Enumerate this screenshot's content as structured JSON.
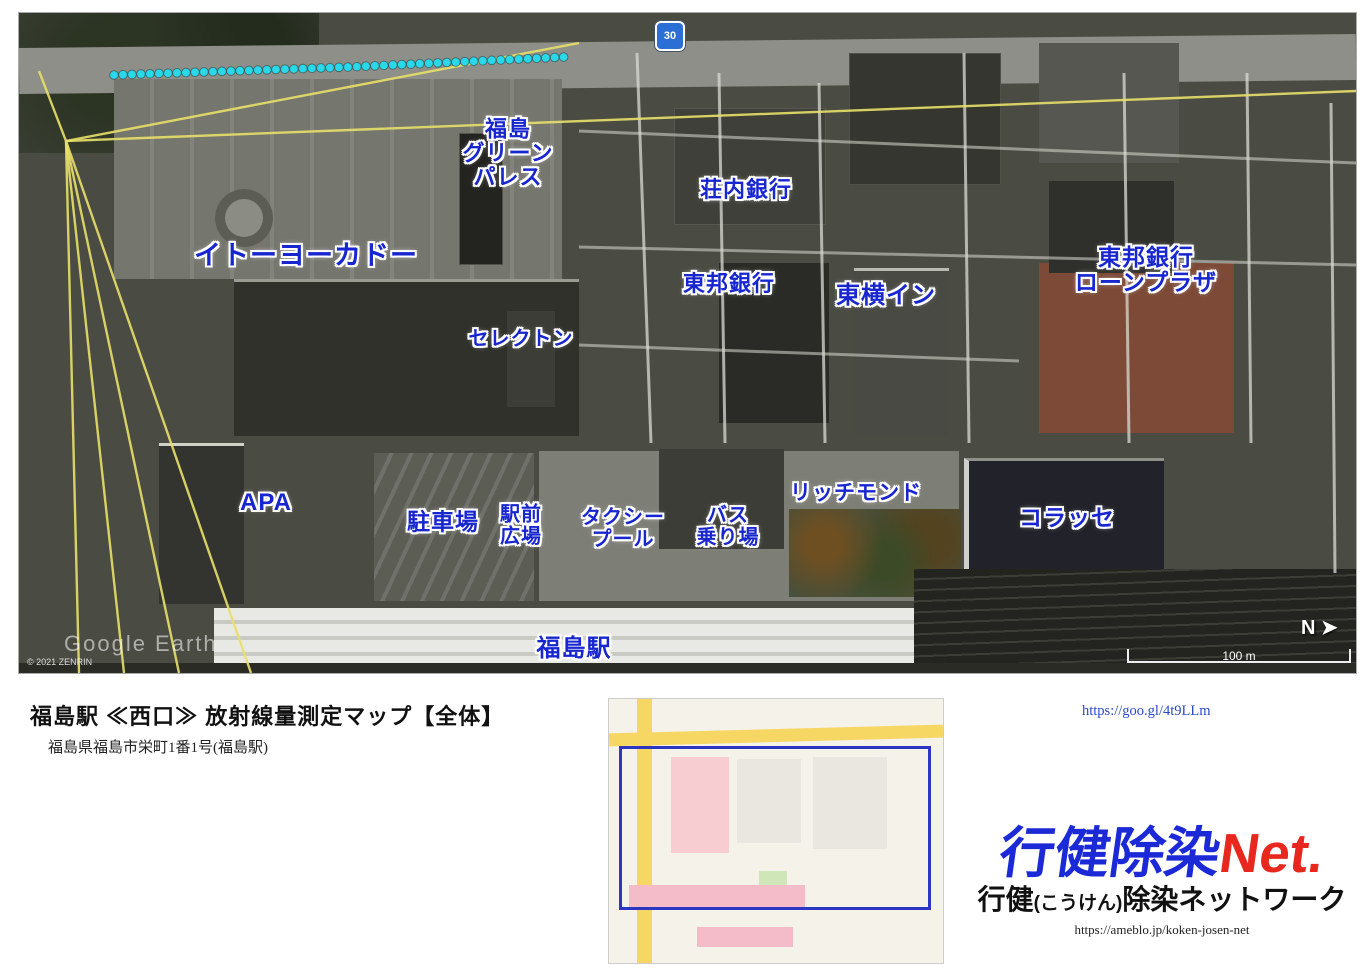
{
  "map": {
    "speed_sign": "30",
    "scale_label": "100 m",
    "north_label": "N",
    "watermark": "Google Earth",
    "copyright": "© 2021 ZENRIN",
    "labels": [
      {
        "t": "イトーヨーカドー",
        "x": 287,
        "y": 243,
        "s": 27
      },
      {
        "t": "福島\nグリーン\nパレス",
        "x": 489,
        "y": 140,
        "s": 22
      },
      {
        "t": "セレクトン",
        "x": 502,
        "y": 327,
        "s": 20
      },
      {
        "t": "荘内銀行",
        "x": 727,
        "y": 177,
        "s": 22
      },
      {
        "t": "東邦銀行",
        "x": 710,
        "y": 271,
        "s": 22
      },
      {
        "t": "東横イン",
        "x": 867,
        "y": 283,
        "s": 24
      },
      {
        "t": "東邦銀行\nローンプラザ",
        "x": 1127,
        "y": 257,
        "s": 23
      },
      {
        "t": "APA",
        "x": 247,
        "y": 490,
        "s": 24
      },
      {
        "t": "駐車場",
        "x": 424,
        "y": 509,
        "s": 23
      },
      {
        "t": "駅前\n広場",
        "x": 502,
        "y": 513,
        "s": 20
      },
      {
        "t": "タクシー\nプール",
        "x": 604,
        "y": 516,
        "s": 20
      },
      {
        "t": "バス\n乗り場",
        "x": 709,
        "y": 514,
        "s": 20
      },
      {
        "t": "リッチモンド",
        "x": 837,
        "y": 481,
        "s": 21
      },
      {
        "t": "コラッセ",
        "x": 1048,
        "y": 505,
        "s": 23
      },
      {
        "t": "福島駅",
        "x": 555,
        "y": 636,
        "s": 24
      }
    ],
    "value_colors": {
      "blue": "#1420dd",
      "cyan": "#2bd8ea",
      "green": "#23d523",
      "yellow": "#f2ee2a",
      "orange": "#f5a21f",
      "red": "#ee1414"
    },
    "runs": [
      {
        "pts": [
          [
            95,
            62
          ],
          [
            330,
            54
          ],
          [
            545,
            44
          ]
        ],
        "v": [
          0.1,
          0.12,
          0.11,
          0.11,
          0.11,
          0.12,
          0.11,
          0.12,
          0.1,
          0.1,
          0.13,
          0.11,
          0.12
        ],
        "side": "A",
        "step": 9
      },
      {
        "pts": [
          [
            663,
            42
          ],
          [
            950,
            76
          ],
          [
            1205,
            114
          ]
        ],
        "v": [
          0.1,
          0.1,
          0.09,
          0.08,
          0.08,
          0.07,
          0.09,
          0.1,
          0.1,
          0.11,
          0.1,
          0.12,
          0.12,
          0.1,
          0.09,
          0.1,
          0.16
        ],
        "side": "A",
        "step": 9
      },
      {
        "pts": [
          [
            1207,
            118
          ],
          [
            1213,
            240
          ],
          [
            1210,
            418
          ]
        ],
        "v": [
          0.11,
          0.2,
          0.09,
          0.09,
          0.06,
          0.04,
          0.08,
          0.09,
          0.12,
          0.1,
          0.13,
          0.11
        ],
        "side": "L",
        "step": 9
      },
      {
        "pts": [
          [
            1294,
            142
          ],
          [
            1300,
            300
          ],
          [
            1297,
            440
          ],
          [
            1295,
            552
          ]
        ],
        "v": [
          0.16,
          0.2,
          0.09,
          0.08,
          0.06,
          0.12,
          0.1,
          0.11,
          0.16,
          0.18,
          0.16
        ],
        "side": "L",
        "step": 10
      },
      {
        "pts": [
          [
            100,
            78
          ],
          [
            107,
            240
          ],
          [
            113,
            418
          ]
        ],
        "v": [
          0.12,
          0.1,
          0.11,
          0.13,
          0.12,
          0.11,
          0.13,
          0.12,
          0.14,
          0.12,
          0.17,
          0.14,
          0.12,
          0.11,
          0.16,
          0.1
        ],
        "side": "L",
        "step": 9
      },
      {
        "pts": [
          [
            338,
            70
          ],
          [
            344,
            240
          ],
          [
            350,
            420
          ]
        ],
        "v": [
          0.1,
          0.12,
          0.16,
          0.12,
          0.13,
          0.12,
          0.14,
          0.12,
          0.13,
          0.11,
          0.14,
          0.15
        ],
        "side": "L",
        "step": 9
      },
      {
        "pts": [
          [
            444,
            82
          ],
          [
            452,
            220
          ],
          [
            458,
            330
          ],
          [
            462,
            420
          ]
        ],
        "v": [
          0.16,
          0.2,
          0.2,
          0.18,
          0.17,
          0.15,
          0.2,
          0.22,
          0.2,
          0.22,
          0.19,
          0.21,
          0.23,
          0.24,
          0.23,
          0.21
        ],
        "side": "L",
        "step": 9.5
      },
      {
        "pts": [
          [
            540,
            50
          ],
          [
            558,
            140
          ],
          [
            574,
            240
          ],
          [
            590,
            330
          ],
          [
            602,
            420
          ]
        ],
        "v": [
          0.07,
          0.05,
          0.09,
          0.05,
          0.09,
          0.14,
          0.13,
          0.08,
          0.06,
          0.07,
          0.08,
          0.07,
          0.09,
          0.1,
          0.12,
          0.09,
          0.08
        ],
        "side": "L",
        "step": 9.5
      },
      {
        "pts": [
          [
            630,
            82
          ],
          [
            637,
            210
          ],
          [
            641,
            320
          ],
          [
            645,
            428
          ]
        ],
        "v": [
          0.09,
          0.08,
          0.07,
          0.07,
          0.06,
          0.05,
          0.04,
          0.07,
          0.05,
          0.07,
          0.12,
          0.1
        ],
        "side": "R",
        "step": 9.5
      },
      {
        "pts": [
          [
            770,
            98
          ],
          [
            777,
            230
          ],
          [
            781,
            330
          ],
          [
            785,
            424
          ]
        ],
        "v": [
          0.08,
          0.07,
          0.1,
          0.1,
          0.11,
          0.08,
          0.11,
          0.1,
          0.09,
          0.11,
          0.12,
          0.13,
          0.13,
          0.11
        ],
        "side": "L",
        "step": 9.5
      },
      {
        "pts": [
          [
            917,
            52
          ],
          [
            922,
            170
          ],
          [
            927,
            290
          ],
          [
            931,
            424
          ]
        ],
        "v": [
          0.09,
          0.07,
          0.11,
          0.12,
          0.13,
          0.11,
          0.16,
          0.08,
          0.12,
          0.16,
          0.13,
          0.14,
          0.15
        ],
        "side": "L",
        "step": 9.5
      },
      {
        "pts": [
          [
            822,
            226
          ],
          [
            933,
            237
          ]
        ],
        "v": [
          0.08,
          0.07,
          0.12,
          0.21,
          0.07
        ],
        "side": "U",
        "step": 9
      },
      {
        "pts": [
          [
            113,
            428
          ],
          [
            420,
            423
          ],
          [
            760,
            428
          ],
          [
            1040,
            425
          ],
          [
            1207,
            420
          ]
        ],
        "v": [
          0.1,
          0.14,
          0.15,
          0.14,
          0.17,
          0.15,
          0.09,
          0.13,
          0.11,
          0.1,
          0.11,
          0.06,
          0.07,
          0.1,
          0.11,
          0.11,
          0.09,
          0.08,
          0.06,
          0.07,
          0.09,
          0.11,
          0.14,
          0.13
        ],
        "side": "U",
        "step": 9
      },
      {
        "pts": [
          [
            130,
            453
          ],
          [
            420,
            450
          ],
          [
            760,
            453
          ],
          [
            1030,
            450
          ],
          [
            1148,
            452
          ]
        ],
        "v": [
          0.08,
          0.06,
          0.07,
          0.1,
          0.08,
          0.06,
          0.06,
          0.05,
          0.04,
          0.07,
          0.05,
          0.05,
          0.04,
          0.04,
          0.09,
          0.07,
          0.06,
          0.07,
          0.08,
          0.06,
          0.08,
          0.09,
          0.1,
          0.07
        ],
        "side": "D",
        "step": 9
      },
      {
        "pts": [
          [
            117,
            445
          ],
          [
            119,
            505
          ],
          [
            121,
            556
          ]
        ],
        "v": [
          0.05,
          0.05,
          0.06,
          0.05,
          0.06,
          0.07,
          0.1
        ],
        "side": "L",
        "step": 9.5
      },
      {
        "pts": [
          [
            128,
            572
          ],
          [
            350,
            578
          ],
          [
            600,
            576
          ],
          [
            752,
            572
          ]
        ],
        "v": [
          0.07,
          0.08,
          0.06,
          0.04,
          0.04,
          0.06,
          0.05,
          0.06,
          0.06,
          0.07,
          0.06,
          0.05,
          0.06,
          0.03,
          0.06,
          0.06,
          0.07,
          0.03,
          0.04,
          0.05,
          0.06,
          0.08
        ],
        "side": "D",
        "step": 9
      },
      {
        "pts": [
          [
            758,
            574
          ],
          [
            950,
            581
          ],
          [
            1193,
            580
          ]
        ],
        "v": [
          0.15,
          0.16,
          0.21,
          0.19,
          0.24,
          0.31,
          0.3,
          0.27,
          0.27,
          0.31,
          0.25,
          0.28,
          0.26,
          0.33,
          0.25,
          0.22,
          0.16
        ],
        "side": "D",
        "step": 10
      },
      {
        "pts": [
          [
            772,
            442
          ],
          [
            777,
            505
          ],
          [
            779,
            560
          ]
        ],
        "v": [
          0.2,
          0.19,
          0.22,
          0.2,
          0.23,
          0.36,
          0.18
        ],
        "side": "R",
        "step": 10
      },
      {
        "pts": [
          [
            642,
            445
          ],
          [
            646,
            510
          ],
          [
            648,
            566
          ]
        ],
        "v": [
          0.05,
          0.07,
          0.05,
          0.08,
          0.06,
          0.06,
          0.09
        ],
        "side": "L",
        "step": 10
      },
      {
        "pts": [
          [
            887,
            445
          ],
          [
            891,
            510
          ],
          [
            893,
            566
          ]
        ],
        "v": [
          0.05,
          0.03,
          0.06,
          0.02,
          0.08,
          0.06,
          0.04,
          0.05
        ],
        "side": "L",
        "step": 10
      },
      {
        "pts": [
          [
            1180,
            448
          ],
          [
            1184,
            520
          ],
          [
            1186,
            580
          ]
        ],
        "v": [
          0.07,
          0.18,
          0.13,
          0.16,
          0.18
        ],
        "side": "L",
        "step": 11
      },
      {
        "pts": [
          [
            357,
            443
          ],
          [
            361,
            510
          ],
          [
            363,
            572
          ]
        ],
        "v": [
          0.07,
          0.05,
          0.05,
          0.06,
          0.05,
          0.06,
          0.05,
          0.07
        ],
        "side": "L",
        "step": 10
      }
    ]
  },
  "info": {
    "title": "福島駅 ≪西口≫ 放射線量測定マップ【全体】",
    "address": "福島県福島市栄町1番1号(福島駅)",
    "details": [
      {
        "label": "◇測　定　日",
        "value": "2021(R03)年03月08日(月曜日)"
      },
      {
        "label": "◇測定単位",
        "value": "μSv/h(マイクロシーベルト毎時)"
      },
      {
        "label": "◇測定機器",
        "value": "ホットスポットファインダー"
      },
      {
        "label": "◇測定高さ",
        "value": "10cm"
      },
      {
        "label": "◇天　　候",
        "value": "はれ"
      },
      {
        "label": "◇地面状況",
        "value": "乾燥"
      },
      {
        "label": "◇制　　作",
        "maker": true
      }
    ],
    "maker_parts": [
      {
        "t": "行健",
        "cls": "mk-b"
      },
      {
        "t": "(こうけん)",
        "cls": "mk-k"
      },
      {
        "t": "除染",
        "cls": "mk-b"
      },
      {
        "t": "ネットワーク",
        "cls": "mk-r"
      }
    ]
  },
  "legend": {
    "items": [
      {
        "color": "#0b10e3",
        "label": "0. 00μ Sv/h 以上"
      },
      {
        "color": "#17e8f4",
        "label": "0. 10μ Sv/h 以上"
      },
      {
        "color": "#19d419",
        "label": "0. 20μ Sv/h 以上"
      },
      {
        "color": "#f2f21b",
        "label": "0. 24μ Sv/h 以上"
      },
      {
        "color": "#f5a11c",
        "label": "0. 30μ Sv/h 以上"
      },
      {
        "color": "#ef1212",
        "label": "0. 40μ Sv/h 以上"
      }
    ]
  },
  "inset": {
    "zones": [
      {
        "t": "④",
        "x": 64,
        "y": 112
      },
      {
        "t": "③",
        "x": 130,
        "y": 110
      },
      {
        "t": "②",
        "x": 202,
        "y": 106
      },
      {
        "t": "①",
        "x": 276,
        "y": 102
      }
    ],
    "ekimae": [
      {
        "t": "駅前\n①",
        "x": 95,
        "y": 166
      },
      {
        "t": "駅前\n②",
        "x": 174,
        "y": 163
      },
      {
        "t": "駅前\n③",
        "x": 252,
        "y": 160
      }
    ]
  },
  "contact": {
    "lines": [
      "「お問い合わせフォーム」",
      "※測定場所のリクエストも",
      "ココからどうぞ。",
      "(お金はかかりません。)"
    ],
    "url": "https://goo.gl/4t9LLm"
  },
  "branding": {
    "logo_blue": "行健除染",
    "logo_red": "Net.",
    "sub_1": "行健",
    "sub_2": "(こうけん)",
    "sub_3": "除染ネットワーク",
    "url": "https://ameblo.jp/koken-josen-net"
  }
}
